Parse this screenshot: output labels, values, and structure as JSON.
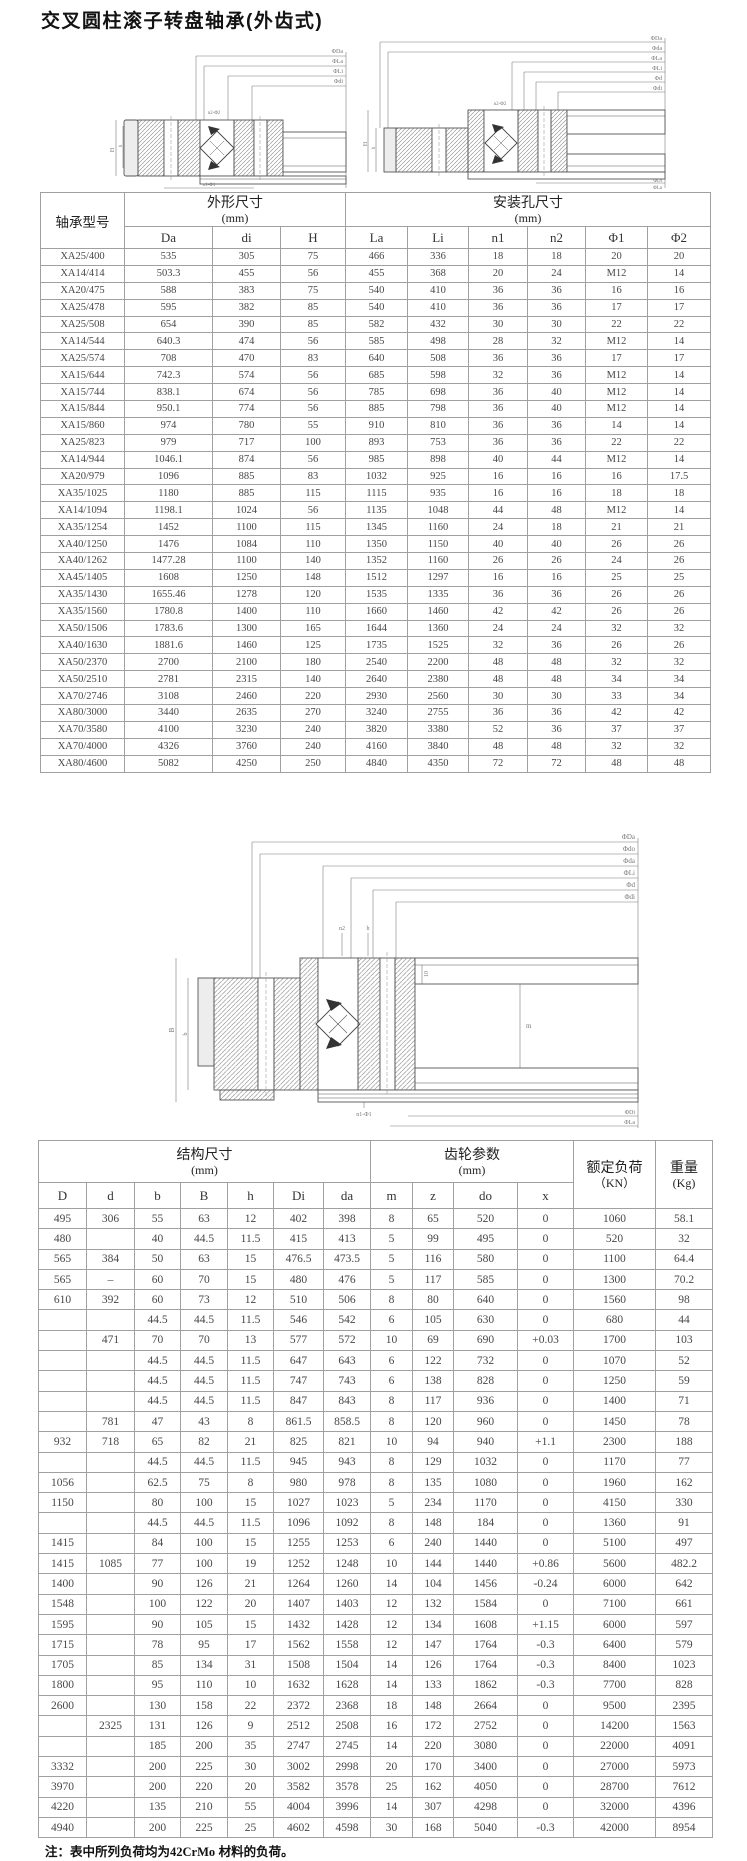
{
  "page": {
    "title": "交叉圆柱滚子转盘轴承(外齿式)",
    "note_label": "注：",
    "note_text_cn1": "表中所列负荷均为",
    "note_material": "42CrMo",
    "note_text_cn2": "材料的负荷。"
  },
  "table1": {
    "header": {
      "model": "轴承型号",
      "group1": "外形尺寸",
      "group1_unit": "(mm)",
      "group2": "安装孔尺寸",
      "group2_unit": "(mm)",
      "cols": [
        "Da",
        "di",
        "H",
        "La",
        "Li",
        "n1",
        "n2",
        "Φ1",
        "Φ2"
      ]
    },
    "rows": [
      [
        "XA25/400",
        "535",
        "305",
        "75",
        "466",
        "336",
        "18",
        "18",
        "20",
        "20"
      ],
      [
        "XA14/414",
        "503.3",
        "455",
        "56",
        "455",
        "368",
        "20",
        "24",
        "M12",
        "14"
      ],
      [
        "XA20/475",
        "588",
        "383",
        "75",
        "540",
        "410",
        "36",
        "36",
        "16",
        "16"
      ],
      [
        "XA25/478",
        "595",
        "382",
        "85",
        "540",
        "410",
        "36",
        "36",
        "17",
        "17"
      ],
      [
        "XA25/508",
        "654",
        "390",
        "85",
        "582",
        "432",
        "30",
        "30",
        "22",
        "22"
      ],
      [
        "XA14/544",
        "640.3",
        "474",
        "56",
        "585",
        "498",
        "28",
        "32",
        "M12",
        "14"
      ],
      [
        "XA25/574",
        "708",
        "470",
        "83",
        "640",
        "508",
        "36",
        "36",
        "17",
        "17"
      ],
      [
        "XA15/644",
        "742.3",
        "574",
        "56",
        "685",
        "598",
        "32",
        "36",
        "M12",
        "14"
      ],
      [
        "XA15/744",
        "838.1",
        "674",
        "56",
        "785",
        "698",
        "36",
        "40",
        "M12",
        "14"
      ],
      [
        "XA15/844",
        "950.1",
        "774",
        "56",
        "885",
        "798",
        "36",
        "40",
        "M12",
        "14"
      ],
      [
        "XA15/860",
        "974",
        "780",
        "55",
        "910",
        "810",
        "36",
        "36",
        "14",
        "14"
      ],
      [
        "XA25/823",
        "979",
        "717",
        "100",
        "893",
        "753",
        "36",
        "36",
        "22",
        "22"
      ],
      [
        "XA14/944",
        "1046.1",
        "874",
        "56",
        "985",
        "898",
        "40",
        "44",
        "M12",
        "14"
      ],
      [
        "XA20/979",
        "1096",
        "885",
        "83",
        "1032",
        "925",
        "16",
        "16",
        "16",
        "17.5"
      ],
      [
        "XA35/1025",
        "1180",
        "885",
        "115",
        "1115",
        "935",
        "16",
        "16",
        "18",
        "18"
      ],
      [
        "XA14/1094",
        "1198.1",
        "1024",
        "56",
        "1135",
        "1048",
        "44",
        "48",
        "M12",
        "14"
      ],
      [
        "XA35/1254",
        "1452",
        "1100",
        "115",
        "1345",
        "1160",
        "24",
        "18",
        "21",
        "21"
      ],
      [
        "XA40/1250",
        "1476",
        "1084",
        "110",
        "1350",
        "1150",
        "40",
        "40",
        "26",
        "26"
      ],
      [
        "XA40/1262",
        "1477.28",
        "1100",
        "140",
        "1352",
        "1160",
        "26",
        "26",
        "24",
        "26"
      ],
      [
        "XA45/1405",
        "1608",
        "1250",
        "148",
        "1512",
        "1297",
        "16",
        "16",
        "25",
        "25"
      ],
      [
        "XA35/1430",
        "1655.46",
        "1278",
        "120",
        "1535",
        "1335",
        "36",
        "36",
        "26",
        "26"
      ],
      [
        "XA35/1560",
        "1780.8",
        "1400",
        "110",
        "1660",
        "1460",
        "42",
        "42",
        "26",
        "26"
      ],
      [
        "XA50/1506",
        "1783.6",
        "1300",
        "165",
        "1644",
        "1360",
        "24",
        "24",
        "32",
        "32"
      ],
      [
        "XA40/1630",
        "1881.6",
        "1460",
        "125",
        "1735",
        "1525",
        "32",
        "36",
        "26",
        "26"
      ],
      [
        "XA50/2370",
        "2700",
        "2100",
        "180",
        "2540",
        "2200",
        "48",
        "48",
        "32",
        "32"
      ],
      [
        "XA50/2510",
        "2781",
        "2315",
        "140",
        "2640",
        "2380",
        "48",
        "48",
        "34",
        "34"
      ],
      [
        "XA70/2746",
        "3108",
        "2460",
        "220",
        "2930",
        "2560",
        "30",
        "30",
        "33",
        "34"
      ],
      [
        "XA80/3000",
        "3440",
        "2635",
        "270",
        "3240",
        "2755",
        "36",
        "36",
        "42",
        "42"
      ],
      [
        "XA70/3580",
        "4100",
        "3230",
        "240",
        "3820",
        "3380",
        "52",
        "36",
        "37",
        "37"
      ],
      [
        "XA70/4000",
        "4326",
        "3760",
        "240",
        "4160",
        "3840",
        "48",
        "48",
        "32",
        "32"
      ],
      [
        "XA80/4600",
        "5082",
        "4250",
        "250",
        "4840",
        "4350",
        "72",
        "72",
        "48",
        "48"
      ]
    ]
  },
  "table2": {
    "header": {
      "group1": "结构尺寸",
      "group1_unit": "(mm)",
      "group2": "齿轮参数",
      "group2_unit": "(mm)",
      "load": "额定负荷",
      "load_unit": "（KN）",
      "weight": "重量",
      "weight_unit": "(Kg)",
      "cols": [
        "D",
        "d",
        "b",
        "B",
        "h",
        "Di",
        "da",
        "m",
        "z",
        "do",
        "x"
      ]
    },
    "rows": [
      [
        "495",
        "306",
        "55",
        "63",
        "12",
        "402",
        "398",
        "8",
        "65",
        "520",
        "0",
        "1060",
        "58.1"
      ],
      [
        "480",
        "",
        "40",
        "44.5",
        "11.5",
        "415",
        "413",
        "5",
        "99",
        "495",
        "0",
        "520",
        "32"
      ],
      [
        "565",
        "384",
        "50",
        "63",
        "15",
        "476.5",
        "473.5",
        "5",
        "116",
        "580",
        "0",
        "1100",
        "64.4"
      ],
      [
        "565",
        "–",
        "60",
        "70",
        "15",
        "480",
        "476",
        "5",
        "117",
        "585",
        "0",
        "1300",
        "70.2"
      ],
      [
        "610",
        "392",
        "60",
        "73",
        "12",
        "510",
        "506",
        "8",
        "80",
        "640",
        "0",
        "1560",
        "98"
      ],
      [
        "",
        "",
        "44.5",
        "44.5",
        "11.5",
        "546",
        "542",
        "6",
        "105",
        "630",
        "0",
        "680",
        "44"
      ],
      [
        "",
        "471",
        "70",
        "70",
        "13",
        "577",
        "572",
        "10",
        "69",
        "690",
        "+0.03",
        "1700",
        "103"
      ],
      [
        "",
        "",
        "44.5",
        "44.5",
        "11.5",
        "647",
        "643",
        "6",
        "122",
        "732",
        "0",
        "1070",
        "52"
      ],
      [
        "",
        "",
        "44.5",
        "44.5",
        "11.5",
        "747",
        "743",
        "6",
        "138",
        "828",
        "0",
        "1250",
        "59"
      ],
      [
        "",
        "",
        "44.5",
        "44.5",
        "11.5",
        "847",
        "843",
        "8",
        "117",
        "936",
        "0",
        "1400",
        "71"
      ],
      [
        "",
        "781",
        "47",
        "43",
        "8",
        "861.5",
        "858.5",
        "8",
        "120",
        "960",
        "0",
        "1450",
        "78"
      ],
      [
        "932",
        "718",
        "65",
        "82",
        "21",
        "825",
        "821",
        "10",
        "94",
        "940",
        "+1.1",
        "2300",
        "188"
      ],
      [
        "",
        "",
        "44.5",
        "44.5",
        "11.5",
        "945",
        "943",
        "8",
        "129",
        "1032",
        "0",
        "1170",
        "77"
      ],
      [
        "1056",
        "",
        "62.5",
        "75",
        "8",
        "980",
        "978",
        "8",
        "135",
        "1080",
        "0",
        "1960",
        "162"
      ],
      [
        "1150",
        "",
        "80",
        "100",
        "15",
        "1027",
        "1023",
        "5",
        "234",
        "1170",
        "0",
        "4150",
        "330"
      ],
      [
        "",
        "",
        "44.5",
        "44.5",
        "11.5",
        "1096",
        "1092",
        "8",
        "148",
        "184",
        "0",
        "1360",
        "91"
      ],
      [
        "1415",
        "",
        "84",
        "100",
        "15",
        "1255",
        "1253",
        "6",
        "240",
        "1440",
        "0",
        "5100",
        "497"
      ],
      [
        "1415",
        "1085",
        "77",
        "100",
        "19",
        "1252",
        "1248",
        "10",
        "144",
        "1440",
        "+0.86",
        "5600",
        "482.2"
      ],
      [
        "1400",
        "",
        "90",
        "126",
        "21",
        "1264",
        "1260",
        "14",
        "104",
        "1456",
        "-0.24",
        "6000",
        "642"
      ],
      [
        "1548",
        "",
        "100",
        "122",
        "20",
        "1407",
        "1403",
        "12",
        "132",
        "1584",
        "0",
        "7100",
        "661"
      ],
      [
        "1595",
        "",
        "90",
        "105",
        "15",
        "1432",
        "1428",
        "12",
        "134",
        "1608",
        "+1.15",
        "6000",
        "597"
      ],
      [
        "1715",
        "",
        "78",
        "95",
        "17",
        "1562",
        "1558",
        "12",
        "147",
        "1764",
        "-0.3",
        "6400",
        "579"
      ],
      [
        "1705",
        "",
        "85",
        "134",
        "31",
        "1508",
        "1504",
        "14",
        "126",
        "1764",
        "-0.3",
        "8400",
        "1023"
      ],
      [
        "1800",
        "",
        "95",
        "110",
        "10",
        "1632",
        "1628",
        "14",
        "133",
        "1862",
        "-0.3",
        "7700",
        "828"
      ],
      [
        "2600",
        "",
        "130",
        "158",
        "22",
        "2372",
        "2368",
        "18",
        "148",
        "2664",
        "0",
        "9500",
        "2395"
      ],
      [
        "",
        "2325",
        "131",
        "126",
        "9",
        "2512",
        "2508",
        "16",
        "172",
        "2752",
        "0",
        "14200",
        "1563"
      ],
      [
        "",
        "",
        "185",
        "200",
        "35",
        "2747",
        "2745",
        "14",
        "220",
        "3080",
        "0",
        "22000",
        "4091"
      ],
      [
        "3332",
        "",
        "200",
        "225",
        "30",
        "3002",
        "2998",
        "20",
        "170",
        "3400",
        "0",
        "27000",
        "5973"
      ],
      [
        "3970",
        "",
        "200",
        "220",
        "20",
        "3582",
        "3578",
        "25",
        "162",
        "4050",
        "0",
        "28700",
        "7612"
      ],
      [
        "4220",
        "",
        "135",
        "210",
        "55",
        "4004",
        "3996",
        "14",
        "307",
        "4298",
        "0",
        "32000",
        "4396"
      ],
      [
        "4940",
        "",
        "200",
        "225",
        "25",
        "4602",
        "4598",
        "30",
        "168",
        "5040",
        "-0.3",
        "42000",
        "8954"
      ]
    ]
  },
  "drawings": {
    "left": {
      "top": [
        "ΦDa",
        "ΦLa",
        "ΦLi",
        "Φdi"
      ],
      "small_top": "n2-Φ2",
      "left": [
        "H",
        "h"
      ],
      "bottom": "n1-Φ1"
    },
    "right": {
      "top": [
        "ΦDa",
        "Φda",
        "ΦLa",
        "ΦLi",
        "Φd",
        "Φdi"
      ],
      "small_top": "n2-Φ2",
      "left": [
        "H",
        "h"
      ],
      "bottom": [
        "ΦDi",
        "ΦLa"
      ]
    },
    "middle": {
      "top": [
        "ΦDa",
        "Φdo",
        "Φda",
        "ΦLi",
        "Φd",
        "Φdi"
      ],
      "small_top": [
        "n2",
        "h"
      ],
      "left": [
        "B",
        "b"
      ],
      "inside": [
        "10",
        "m"
      ],
      "bottom": [
        "n1-Φ1",
        "ΦDi",
        "ΦLa"
      ]
    }
  }
}
